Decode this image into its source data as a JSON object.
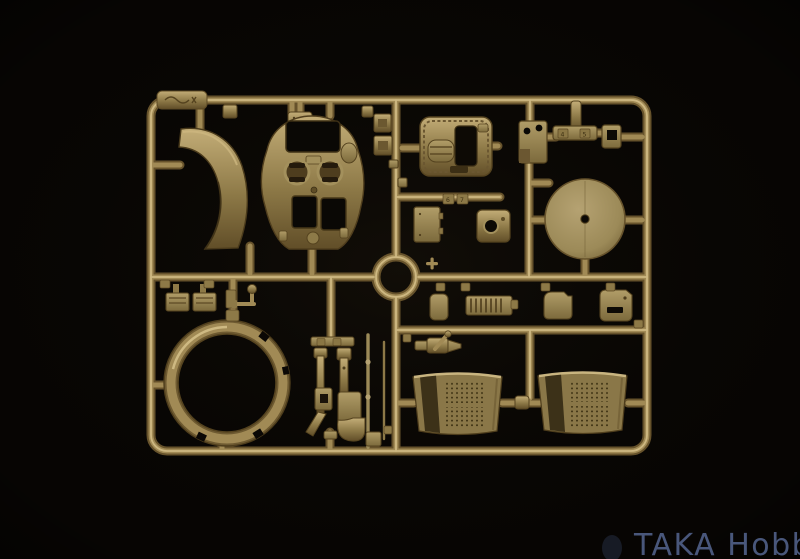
{
  "meta": {
    "type": "photograph",
    "subject": "Injection-molded plastic model kit sprue (parts tree) in olive-tan plastic photographed on a black background"
  },
  "colors": {
    "background": "#070503",
    "plastic_base": "#97824f",
    "plastic_highlight": "#d6c18b",
    "plastic_shadow": "#5d4a25",
    "disc_face": "#a29058",
    "opening_dark": "#0a0805",
    "watermark": "#4d5c82"
  },
  "watermark": {
    "text": "TAKA Hobby"
  },
  "sprue": {
    "part_tags": [
      "4",
      "5",
      "6",
      "7"
    ],
    "parts": [
      "cab-front-panel-with-gauges",
      "curved-front-fender",
      "seat-bracket-block",
      "two-hole-flat-plate",
      "t-shaped-linkage",
      "small-clip-ring",
      "flywheel-disc",
      "hinged-door-panel",
      "plate-with-round-bore",
      "foot-pedal-pair",
      "lever-with-ball-end",
      "ribbed-grille-plate",
      "small-hatch-plates",
      "wheel-rim-ring",
      "front-fork-halves",
      "thin-axle-rods",
      "valve-fitting-with-handle",
      "perforated-side-panel-left",
      "perforated-side-panel-right"
    ]
  }
}
